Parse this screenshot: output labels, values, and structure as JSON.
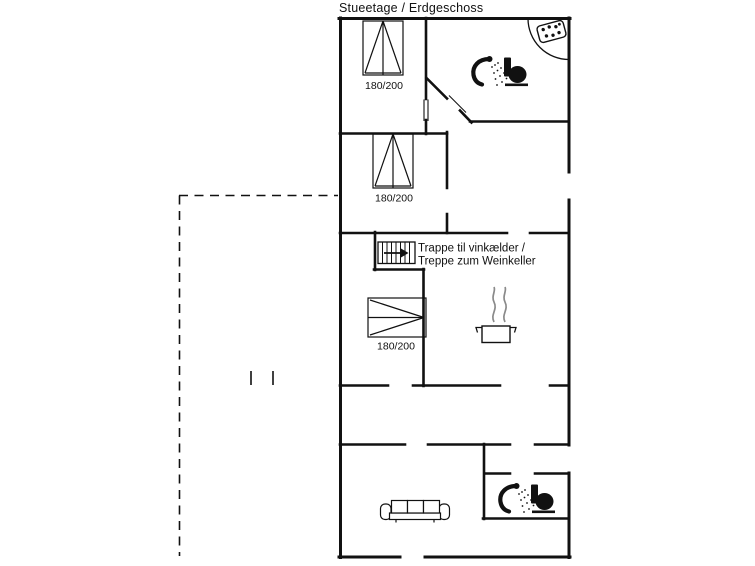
{
  "title": "Stueetage / Erdgeschoss",
  "beds": [
    {
      "id": "bed-1",
      "size": "180/200"
    },
    {
      "id": "bed-2",
      "size": "180/200"
    },
    {
      "id": "bed-3",
      "size": "180/200"
    }
  ],
  "stairs_note": {
    "line1": "Trappe til vinkælder /",
    "line2": "Treppe zum Weinkeller"
  },
  "icons": {
    "stairs": "stairs-down-icon",
    "shower_top": "shower-icon",
    "toilet_top": "toilet-icon",
    "whirlpool": "whirlpool-icon",
    "cooking_pot": "cooking-pot-icon",
    "sofa": "sofa-icon",
    "shower_bottom": "shower-icon",
    "toilet_bottom": "toilet-icon"
  },
  "colors": {
    "wall": "#111111",
    "text": "#111111",
    "steam": "#8a8a8a",
    "background": "#ffffff"
  }
}
